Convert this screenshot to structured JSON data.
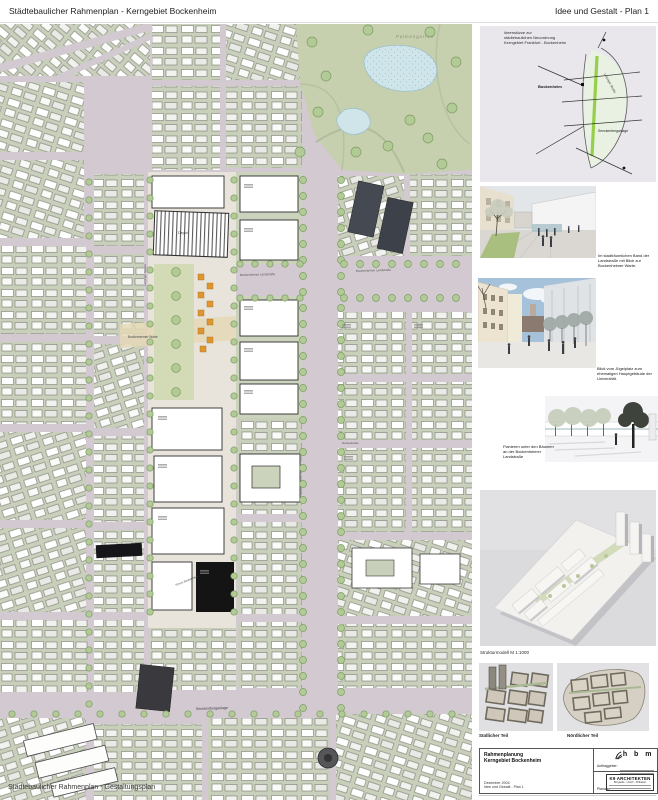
{
  "header": {
    "left_title": "Städtebaulicher Rahmenplan - Kerngebiet Bockenheim",
    "right_title": "Idee und Gestalt - Plan 1"
  },
  "map": {
    "overlay_title": "Städtebaulicher Rahmenplan - Gestaltungsplan",
    "labels": {
      "park": "Palmengarten",
      "bockenheimer_landstrasse_west": "Bockenheimer Landstraße",
      "bockenheimer_landstrasse_east": "Bockenheimer Landstraße",
      "dantestrasse": "Dantestraße",
      "senckenberganlage": "Senckenberganlage",
      "bockenheimer_warte": "Bockenheimer Warte",
      "depot": "Depot",
      "platz": "Platz",
      "forum": "Forum Bockenheim",
      "leipziger_strasse": "Leipziger Straße"
    },
    "accent_colors": {
      "street": "#d2c9d1",
      "block": "#c8cfba",
      "park": "#c6d0ae",
      "pond": "#cfe5ea",
      "corridor": "#e8e4db",
      "stalls": "#dd9630",
      "tree": "#b2ca96"
    }
  },
  "sidebar": {
    "sketch": {
      "title_line1": "Ideenskizze zur",
      "title_line2": "städtebaulichen Neuordnung",
      "title_line3": "Kerngebiet Frankfurt - Bockenheim",
      "labels": {
        "bockenheim": "Bockenheim",
        "senckenberganlage": "Senckenberganlage",
        "leipziger": "Leipziger Straße"
      }
    },
    "renderings": [
      {
        "caption": "Im stadträumlichen Band der Landstraße mit Blick zur Bockenheimer Warte."
      },
      {
        "caption": "Blick vom Jügelplatz zum ehemaligen Hauptgebäude der Universität."
      },
      {
        "caption": "Flanieren unter den Bäumen an der Bockenheimer Landstraße"
      }
    ],
    "model_caption": "Strukturmodell  M 1:1000",
    "small_models": {
      "left": "Südlicher Teil",
      "right": "Nördlicher Teil"
    },
    "titleblock": {
      "project_line1": "Rahmenplanung",
      "project_line2": "Kerngebiet Bockenheim",
      "date": "Dezember 2004",
      "plan_name": "Idee und Gestalt - Plan 1",
      "client_label": "Auftraggeber:",
      "client_logo_text": "h b m",
      "planning_label": "Planung:",
      "architect_name": "K9 ARCHITEKTEN",
      "architect_partners": "Borgards . Lösch . Piribauer"
    }
  }
}
